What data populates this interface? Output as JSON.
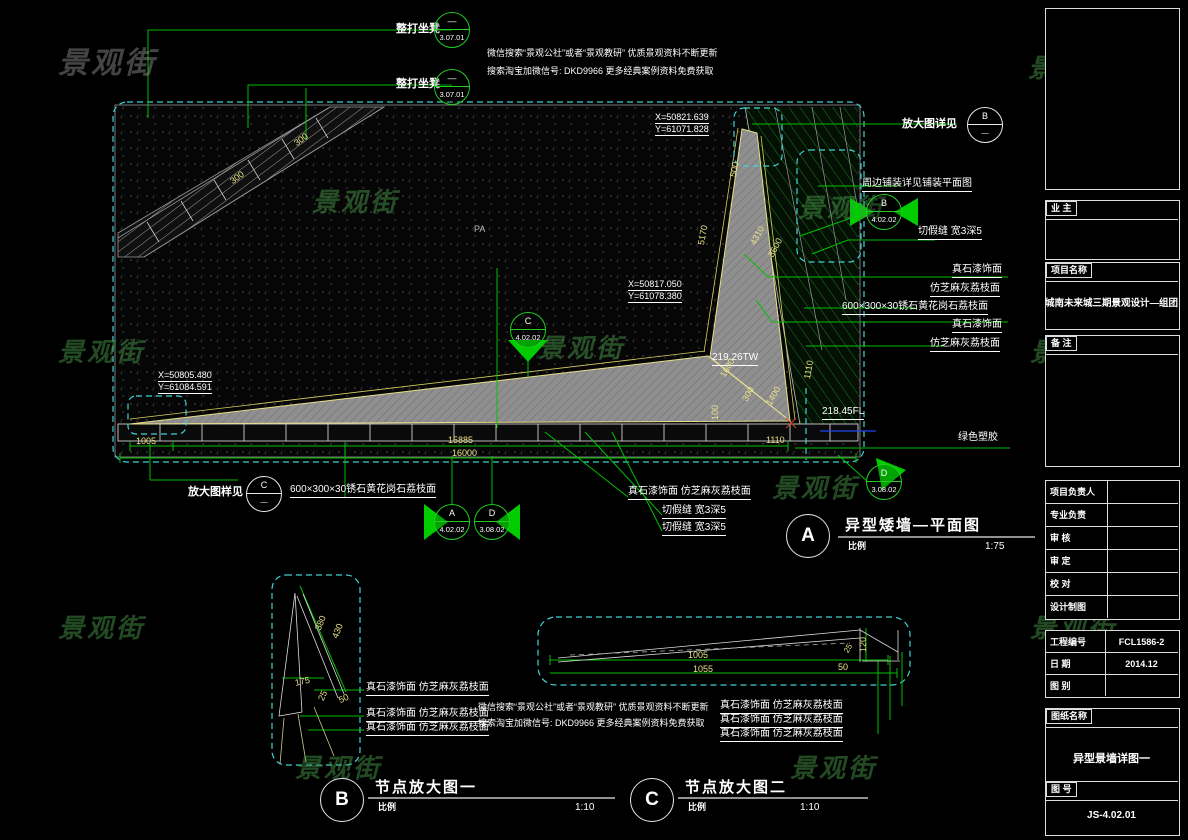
{
  "watermark": "景观街",
  "notes": {
    "line1": "微信搜索“景观公社”或者“景观教研”  优质景观资料不断更新",
    "line2": "搜索淘宝加微信号: DKD9966   更多经典案例资料免费获取"
  },
  "plan": {
    "seat_callout": {
      "label": "整打坐凳",
      "ref_top": "—",
      "ref_bottom": "3.07.01"
    },
    "enlarged_view_b": {
      "label": "放大图详见",
      "letter": "B",
      "ref": "—"
    },
    "enlarged_view_c": {
      "label": "放大图样见",
      "letter": "C",
      "ref": "—"
    },
    "paving_note": "周边铺装详见铺装平面图",
    "joint_note": "切假缝 宽3深5",
    "section_a": {
      "letter": "A",
      "sheet": "4.02.02"
    },
    "section_b": {
      "letter": "B",
      "sheet": "4.02.02"
    },
    "section_c": {
      "letter": "C",
      "sheet": "4.02.02"
    },
    "section_d": {
      "letter": "D",
      "sheet": "3.08.02"
    },
    "finishes": {
      "stone_paint": "真石漆饰面",
      "litchi": "仿芝麻灰荔枝面",
      "granite": "600×300×30锈石黄花岗石荔枝面",
      "combo": "真石漆饰面 仿芝麻灰荔枝面",
      "green_rubber": "绿色塑胶"
    },
    "labels": {
      "pa": "PA"
    },
    "coords": [
      {
        "x": "X=50821.639",
        "y": "Y=61071.828"
      },
      {
        "x": "X=50817.050",
        "y": "Y=61078.380"
      },
      {
        "x": "X=50805.480",
        "y": "Y=61084.591"
      }
    ],
    "levels": {
      "tw": "219.26TW",
      "fl": "218.45FL"
    },
    "dims": {
      "d1005": "1005",
      "d15885": "15885",
      "d16000": "16000",
      "d1110": "1110",
      "d100": "100",
      "d300": "300",
      "d500": "500",
      "d5170": "5170",
      "d3600": "3600",
      "d4310": "4310",
      "d1600": "1600",
      "d1400": "1400"
    },
    "title": {
      "letter": "A",
      "text": "异型矮墙—平面图",
      "scale_label": "比例",
      "scale": "1:75"
    }
  },
  "detail_b": {
    "title": {
      "letter": "B",
      "text": "节点放大图一",
      "scale_label": "比例",
      "scale": "1:10"
    },
    "dims": {
      "d380": "380",
      "d430": "430",
      "d175": "175",
      "d25": "25",
      "d50": "50"
    },
    "annotations": [
      "真石漆饰面 仿芝麻灰荔枝面",
      "真石漆饰面 仿芝麻灰荔枝面",
      "真石漆饰面 仿芝麻灰荔枝面"
    ]
  },
  "detail_c": {
    "title": {
      "letter": "C",
      "text": "节点放大图二",
      "scale_label": "比例",
      "scale": "1:10"
    },
    "dims": {
      "d1005": "1005",
      "d1055": "1055",
      "d120": "120",
      "d50": "50",
      "d25": "25"
    },
    "annotations": [
      "真石漆饰面 仿芝麻灰荔枝面",
      "真石漆饰面 仿芝麻灰荔枝面",
      "真石漆饰面 仿芝麻灰荔枝面"
    ]
  },
  "title_block": {
    "owner_label": "业  主",
    "project_label": "项目名称",
    "project_name": "城南未来城三期景观设计—组团",
    "remarks_label": "备  注",
    "staff_rows": [
      "项目负责人",
      "专业负责",
      "审  核",
      "审  定",
      "校  对",
      "设计制图"
    ],
    "project_no_label": "工程编号",
    "project_no": "FCL1586-2",
    "date_label": "日  期",
    "date": "2014.12",
    "sheet_type_label": "图  别",
    "sheet_name_label": "图纸名称",
    "sheet_name": "异型景墙详图一",
    "sheet_no_label": "图  号",
    "sheet_no": "JS-4.02.01"
  },
  "colors": {
    "line_green": "#00c000",
    "dim_yellow": "#e8e08a",
    "dashed_cyan": "#3fd3d3",
    "wall_gray": "#8f8f8f"
  }
}
